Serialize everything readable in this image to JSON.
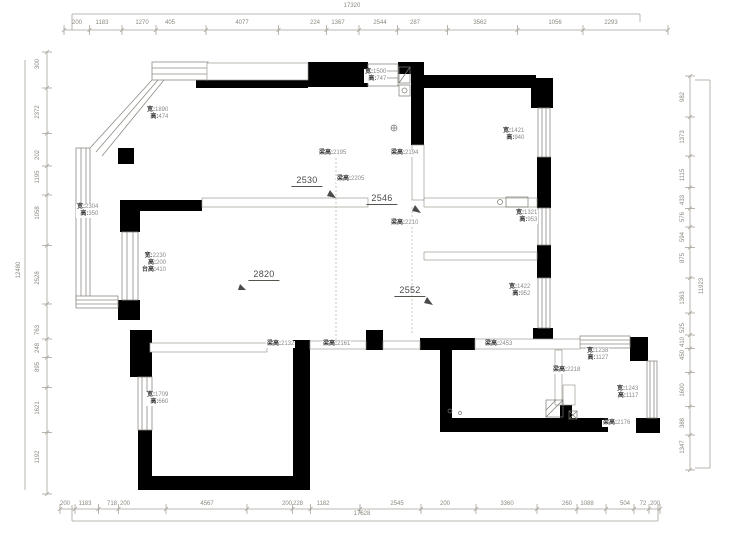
{
  "app": {
    "type": "floor-plan-survey-drawing",
    "background": "#ffffff"
  },
  "colors": {
    "wall": "#000000",
    "dimension_line": "#a8a39a",
    "dimension_text": "#8c8880",
    "annotation_prefix": "#3c3c3c",
    "annotation_value": "#8a8a8a",
    "measure_text": "#4a4a4a",
    "window_line": "#8f8b84"
  },
  "dimensions": {
    "top": {
      "total": {
        "v": "17320",
        "x": 352,
        "y": 6
      },
      "segments": [
        {
          "v": "200",
          "x": 77
        },
        {
          "v": "1183",
          "x": 102
        },
        {
          "v": "1270",
          "x": 142
        },
        {
          "v": "405",
          "x": 170
        },
        {
          "v": "4077",
          "x": 242
        },
        {
          "v": "224",
          "x": 315
        },
        {
          "v": "1367",
          "x": 338
        },
        {
          "v": "2544",
          "x": 380
        },
        {
          "v": "287",
          "x": 415
        },
        {
          "v": "3562",
          "x": 480
        },
        {
          "v": "1056",
          "x": 555
        },
        {
          "v": "2293",
          "x": 611
        }
      ]
    },
    "bottom": {
      "total": {
        "v": "17628",
        "x": 362,
        "y": 514
      },
      "segments": [
        {
          "v": "200",
          "x": 65
        },
        {
          "v": "1183",
          "x": 85
        },
        {
          "v": "718",
          "x": 112
        },
        {
          "v": "200",
          "x": 125
        },
        {
          "v": "4567",
          "x": 207
        },
        {
          "v": "200",
          "x": 287
        },
        {
          "v": "228",
          "x": 298
        },
        {
          "v": "1182",
          "x": 323
        },
        {
          "v": "2545",
          "x": 397
        },
        {
          "v": "200",
          "x": 445
        },
        {
          "v": "3360",
          "x": 507
        },
        {
          "v": "260",
          "x": 567
        },
        {
          "v": "1088",
          "x": 587
        },
        {
          "v": "504",
          "x": 625
        },
        {
          "v": "72",
          "x": 643
        },
        {
          "v": "200",
          "x": 655
        }
      ]
    },
    "left": {
      "total": {
        "v": "12480",
        "x": 19,
        "y": 270
      },
      "segments": [
        {
          "v": "300",
          "y": 64
        },
        {
          "v": "2372",
          "y": 112
        },
        {
          "v": "202",
          "y": 155
        },
        {
          "v": "1195",
          "y": 177
        },
        {
          "v": "1058",
          "y": 213
        },
        {
          "v": "2528",
          "y": 278
        },
        {
          "v": "763",
          "y": 330
        },
        {
          "v": "248",
          "y": 348
        },
        {
          "v": "895",
          "y": 367
        },
        {
          "v": "1621",
          "y": 408
        },
        {
          "v": "1192",
          "y": 457
        }
      ]
    },
    "right": {
      "total": {
        "v": "11923",
        "x": 702,
        "y": 286
      },
      "segments": [
        {
          "v": "982",
          "y": 97
        },
        {
          "v": "1373",
          "y": 137
        },
        {
          "v": "1115",
          "y": 175
        },
        {
          "v": "433",
          "y": 200
        },
        {
          "v": "576",
          "y": 217
        },
        {
          "v": "594",
          "y": 237
        },
        {
          "v": "875",
          "y": 258
        },
        {
          "v": "1363",
          "y": 298
        },
        {
          "v": "525",
          "y": 328
        },
        {
          "v": "410",
          "y": 342
        },
        {
          "v": "450",
          "y": 355
        },
        {
          "v": "1600",
          "y": 390
        },
        {
          "v": "388",
          "y": 423
        },
        {
          "v": "1347",
          "y": 447
        }
      ]
    }
  },
  "window_labels": [
    {
      "lines": [
        "宽:1890",
        "高:474"
      ],
      "x": 146,
      "y": 107
    },
    {
      "lines": [
        "宽:2304",
        "高:350"
      ],
      "x": 76,
      "y": 204
    },
    {
      "lines": [
        "宽:1500",
        "高:747"
      ],
      "x": 364,
      "y": 69
    },
    {
      "lines": [
        "宽:1421",
        "高:940"
      ],
      "x": 502,
      "y": 128
    },
    {
      "lines": [
        "宽:1321",
        "高:953"
      ],
      "x": 515,
      "y": 210
    },
    {
      "lines": [
        "宽:1422",
        "高:952"
      ],
      "x": 508,
      "y": 284
    },
    {
      "lines": [
        "宽:2230",
        "高:200",
        "台高:410"
      ],
      "x": 141,
      "y": 253
    },
    {
      "lines": [
        "宽:1709",
        "高:660"
      ],
      "x": 146,
      "y": 392
    },
    {
      "lines": [
        "宽:1238",
        "高:1127"
      ],
      "x": 586,
      "y": 348
    },
    {
      "lines": [
        "宽:1243",
        "高:1117"
      ],
      "x": 616,
      "y": 386
    }
  ],
  "beam_height_labels": [
    {
      "text": "梁高:2195",
      "x": 318,
      "y": 150
    },
    {
      "text": "梁高:2194",
      "x": 390,
      "y": 150
    },
    {
      "text": "梁高:2205",
      "x": 336,
      "y": 176
    },
    {
      "text": "梁高:2210",
      "x": 390,
      "y": 220
    },
    {
      "text": "梁高:2132",
      "x": 266,
      "y": 341
    },
    {
      "text": "梁高:2161",
      "x": 322,
      "y": 341
    },
    {
      "text": "梁高:2453",
      "x": 484,
      "y": 341
    },
    {
      "text": "梁高:2218",
      "x": 552,
      "y": 367
    },
    {
      "text": "梁高:2176",
      "x": 602,
      "y": 420
    }
  ],
  "measures": [
    {
      "text": "2530",
      "x": 307,
      "y": 175
    },
    {
      "text": "2546",
      "x": 382,
      "y": 193
    },
    {
      "text": "2820",
      "x": 264,
      "y": 269
    },
    {
      "text": "2552",
      "x": 410,
      "y": 285
    }
  ]
}
